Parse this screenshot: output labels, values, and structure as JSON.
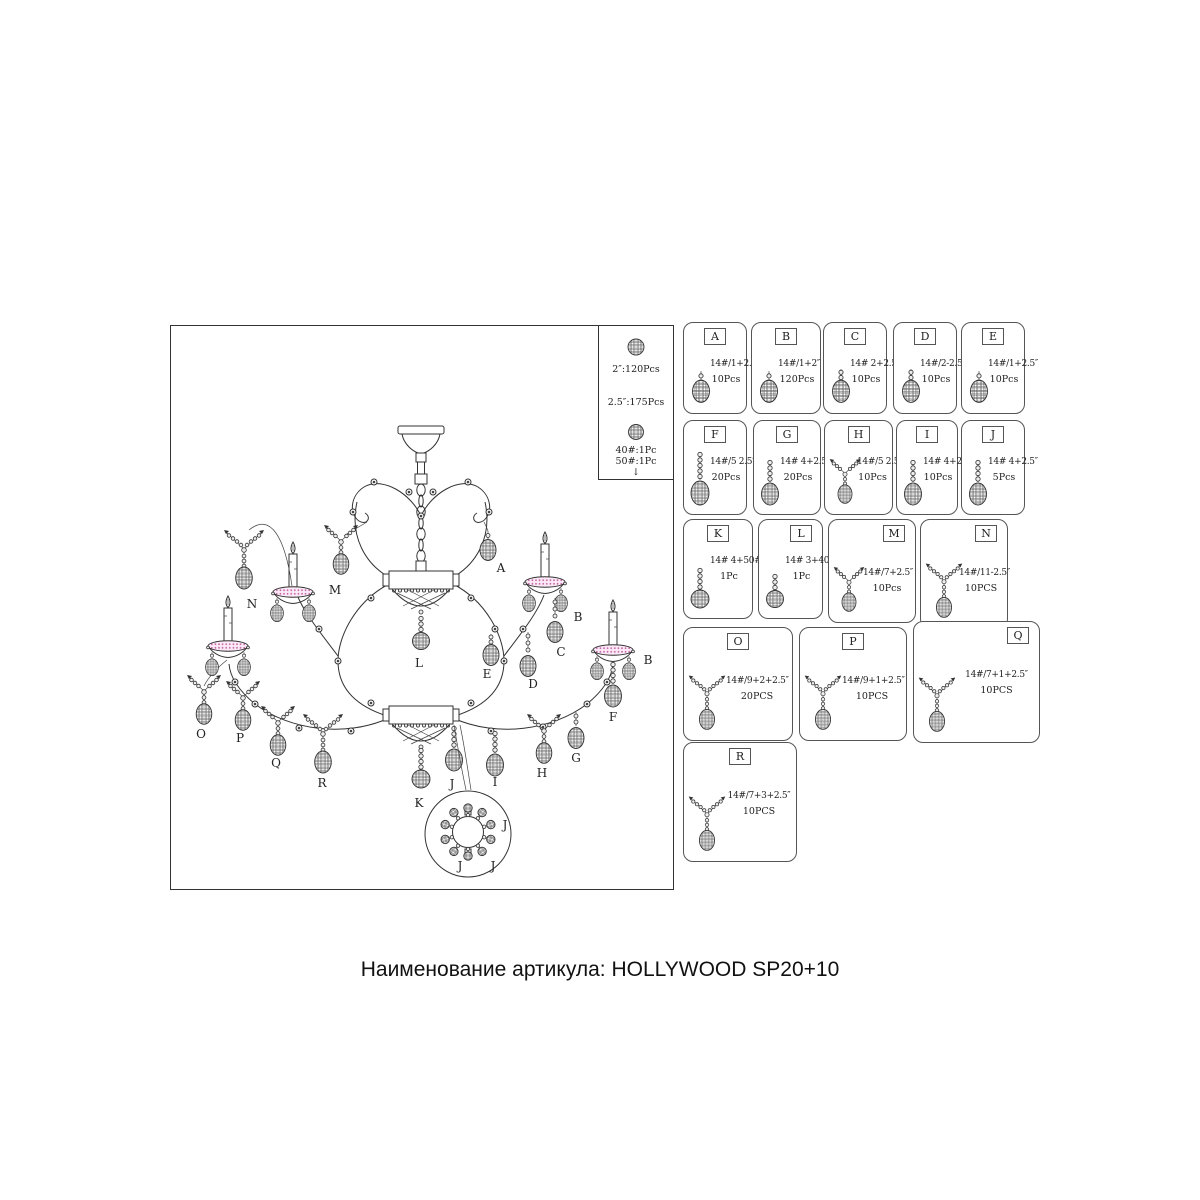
{
  "caption": "Наименование артикула: HOLLYWOOD SP20+10",
  "legend": {
    "l1": "2″:120Pcs",
    "l2": "2.5″:175Pcs",
    "l3": "40#:1Pc",
    "l4": "50#:1Pc",
    "arrow": "↓"
  },
  "parts": [
    {
      "id": "A",
      "spec": "14#/1+2.5″",
      "qty": "10Pcs"
    },
    {
      "id": "B",
      "spec": "14#/1+2″",
      "qty": "120Pcs"
    },
    {
      "id": "C",
      "spec": "14# 2+2.5″",
      "qty": "10Pcs"
    },
    {
      "id": "D",
      "spec": "14#/2-2.5″",
      "qty": "10Pcs"
    },
    {
      "id": "E",
      "spec": "14#/1+2.5″",
      "qty": "10Pcs"
    },
    {
      "id": "F",
      "spec": "14#/5 2.5″",
      "qty": "20Pcs"
    },
    {
      "id": "G",
      "spec": "14# 4+2.5″",
      "qty": "20Pcs"
    },
    {
      "id": "H",
      "spec": "14#/5 2.5″",
      "qty": "10Pcs"
    },
    {
      "id": "I",
      "spec": "14# 4+2.5″",
      "qty": "10Pcs"
    },
    {
      "id": "J",
      "spec": "14# 4+2.5″",
      "qty": "5Pcs"
    },
    {
      "id": "K",
      "spec": "14# 4+50#",
      "qty": "1Pc"
    },
    {
      "id": "L",
      "spec": "14# 3+40#",
      "qty": "1Pc"
    },
    {
      "id": "M",
      "spec": "14#/7+2.5″",
      "qty": "10Pcs"
    },
    {
      "id": "N",
      "spec": "14#/11-2.5″",
      "qty": "10PCS"
    },
    {
      "id": "O",
      "spec": "14#/9+2+2.5″",
      "qty": "20PCS"
    },
    {
      "id": "P",
      "spec": "14#/9+1+2.5″",
      "qty": "10PCS"
    },
    {
      "id": "Q",
      "spec": "14#/7+1+2.5″",
      "qty": "10PCS"
    },
    {
      "id": "R",
      "spec": "14#/7+3+2.5″",
      "qty": "10PCS"
    }
  ],
  "diagram": {
    "labels": {
      "a": "A",
      "b1": "B",
      "b2": "B",
      "c": "C",
      "d": "D",
      "e": "E",
      "f": "F",
      "g": "G",
      "h": "H",
      "i": "I",
      "j": "J",
      "k": "K",
      "l": "L",
      "m": "M",
      "n": "N",
      "o": "O",
      "p": "P",
      "q": "Q",
      "r": "R",
      "j1": "J",
      "j2": "J",
      "j3": "J"
    }
  }
}
